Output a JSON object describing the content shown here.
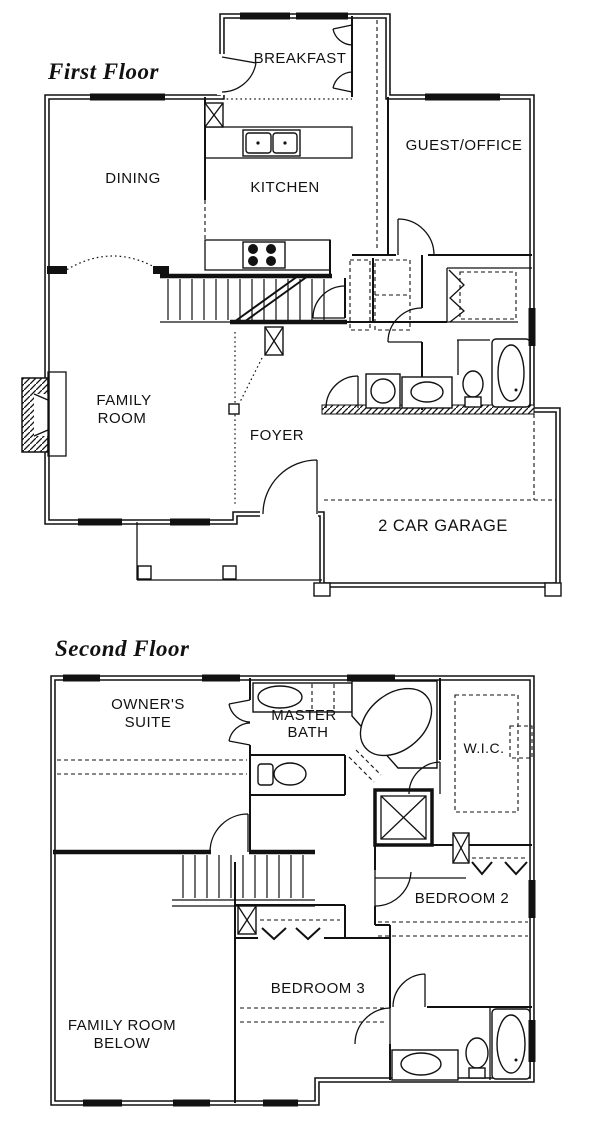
{
  "first_floor": {
    "title": "First Floor",
    "rooms": {
      "breakfast": "BREAKFAST",
      "dining": "DINING",
      "kitchen": "KITCHEN",
      "guest_office": "GUEST/OFFICE",
      "family_room": {
        "line1": "FAMILY",
        "line2": "ROOM"
      },
      "foyer": "FOYER",
      "garage": "2 CAR GARAGE"
    }
  },
  "second_floor": {
    "title": "Second Floor",
    "rooms": {
      "owners_suite": {
        "line1": "OWNER'S",
        "line2": "SUITE"
      },
      "master_bath": {
        "line1": "MASTER",
        "line2": "BATH"
      },
      "wic": "W.I.C.",
      "bedroom2": "BEDROOM 2",
      "bedroom3": "BEDROOM 3",
      "family_room_below": {
        "line1": "FAMILY ROOM",
        "line2": "BELOW"
      }
    }
  },
  "colors": {
    "ink": "#111111",
    "paper": "#ffffff"
  }
}
